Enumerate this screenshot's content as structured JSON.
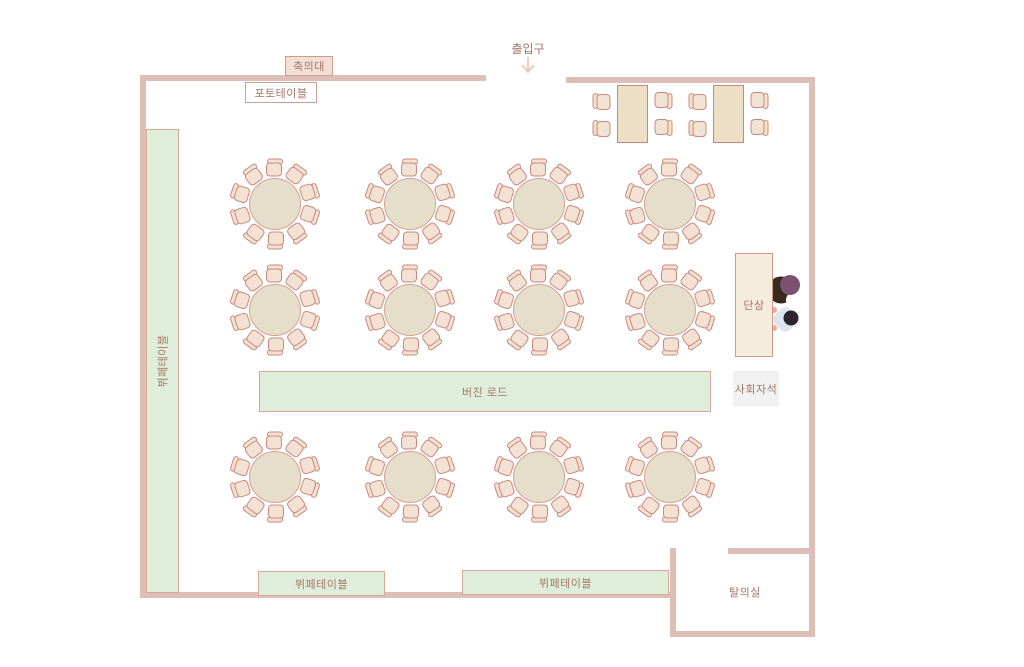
{
  "labels": {
    "entrance": "출입구",
    "gift_desk": "축의대",
    "photo_table": "포토테이블",
    "side_buffet": "뷔페테이블",
    "virgin_road": "버진 로드",
    "buffet_1": "뷔페테이블",
    "buffet_2": "뷔페테이블",
    "podium": "단상",
    "mc_seat": "사회자석",
    "dressing_room": "탈의실"
  },
  "colors": {
    "wall": "#ddbfb7",
    "label": "#a5756b",
    "green": "#dfeeda",
    "greenBorder": "#d5a897",
    "pinkBox": "#f5dfd5",
    "pinkBorder": "#c9a091",
    "beigeBox": "#f6ecdb",
    "beigeBorder": "#cf9a88",
    "grayBox": "#f1f1f1",
    "tableFill": "#e5decb",
    "tableBorder": "#d5a193",
    "rectFill": "#ecdfc6",
    "rectBorder": "#c28b7c",
    "chairFill": "#f3e2d3",
    "chairBorder": "#c8897c",
    "arrow": "#e7bfb4",
    "person1_hair": "#3a2a1e",
    "person1_head": "#7b5170",
    "person2_body": "#dce6f1",
    "person2_head": "#2c2430",
    "person2_hands": "#eba9a2"
  },
  "floorplan": {
    "width": 1024,
    "height": 667,
    "walls": [
      {
        "x": 140,
        "y": 75,
        "w": 346,
        "h": 6
      },
      {
        "x": 566,
        "y": 77,
        "w": 249,
        "h": 6
      },
      {
        "x": 140,
        "y": 75,
        "w": 6,
        "h": 523
      },
      {
        "x": 140,
        "y": 592,
        "w": 536,
        "h": 6
      },
      {
        "x": 809,
        "y": 77,
        "w": 6,
        "h": 560
      },
      {
        "x": 670,
        "y": 548,
        "w": 6,
        "h": 89
      },
      {
        "x": 728,
        "y": 548,
        "w": 87,
        "h": 6
      },
      {
        "x": 670,
        "y": 631,
        "w": 145,
        "h": 6
      }
    ],
    "boxes": [
      {
        "name": "gift-desk",
        "label": "gift_desk",
        "style": "pink",
        "x": 285,
        "y": 56,
        "w": 48,
        "h": 20
      },
      {
        "name": "photo-table",
        "label": "photo_table",
        "style": "white",
        "x": 245,
        "y": 82,
        "w": 72,
        "h": 21
      },
      {
        "name": "side-buffet",
        "label": "side_buffet",
        "style": "green",
        "x": 146,
        "y": 129,
        "w": 33,
        "h": 464,
        "vertical": true
      },
      {
        "name": "virgin-road",
        "label": "virgin_road",
        "style": "green",
        "x": 259,
        "y": 371,
        "w": 452,
        "h": 41
      },
      {
        "name": "buffet-1",
        "label": "buffet_1",
        "style": "green",
        "x": 258,
        "y": 571,
        "w": 127,
        "h": 25
      },
      {
        "name": "buffet-2",
        "label": "buffet_2",
        "style": "green",
        "x": 462,
        "y": 570,
        "w": 207,
        "h": 25
      },
      {
        "name": "podium",
        "label": "podium",
        "style": "beige",
        "x": 735,
        "y": 253,
        "w": 38,
        "h": 104
      },
      {
        "name": "mc-seat",
        "label": "mc_seat",
        "style": "gray",
        "x": 733,
        "y": 371,
        "w": 46,
        "h": 35
      },
      {
        "name": "dressing-room",
        "label": "dressing_room",
        "style": "bare",
        "x": 715,
        "y": 584,
        "w": 60,
        "h": 15
      }
    ],
    "round_tables": {
      "radius": 26,
      "seats": 10,
      "chair_distance": 36,
      "centers": [
        [
          275,
          204
        ],
        [
          410,
          204
        ],
        [
          539,
          204
        ],
        [
          670,
          204
        ],
        [
          275,
          310
        ],
        [
          410,
          310
        ],
        [
          539,
          310
        ],
        [
          670,
          310
        ],
        [
          275,
          477
        ],
        [
          410,
          477
        ],
        [
          539,
          477
        ],
        [
          670,
          477
        ]
      ]
    },
    "rect_tables": {
      "w": 31,
      "h": 58,
      "positions": [
        [
          617,
          85
        ],
        [
          713,
          85
        ]
      ],
      "chairs": [
        {
          "cx": -15,
          "cy": 16,
          "rot": -90
        },
        {
          "cx": -15,
          "cy": 43,
          "rot": -90
        },
        {
          "cx": 46,
          "cy": 16,
          "rot": 90
        },
        {
          "cx": 46,
          "cy": 43,
          "rot": 90
        }
      ]
    },
    "entrance": {
      "label_x": 528,
      "label_y": 40,
      "arrow_x": 516,
      "arrow_y": 56
    },
    "people": [
      {
        "name": "person-groom"
      },
      {
        "name": "person-bride"
      }
    ]
  }
}
